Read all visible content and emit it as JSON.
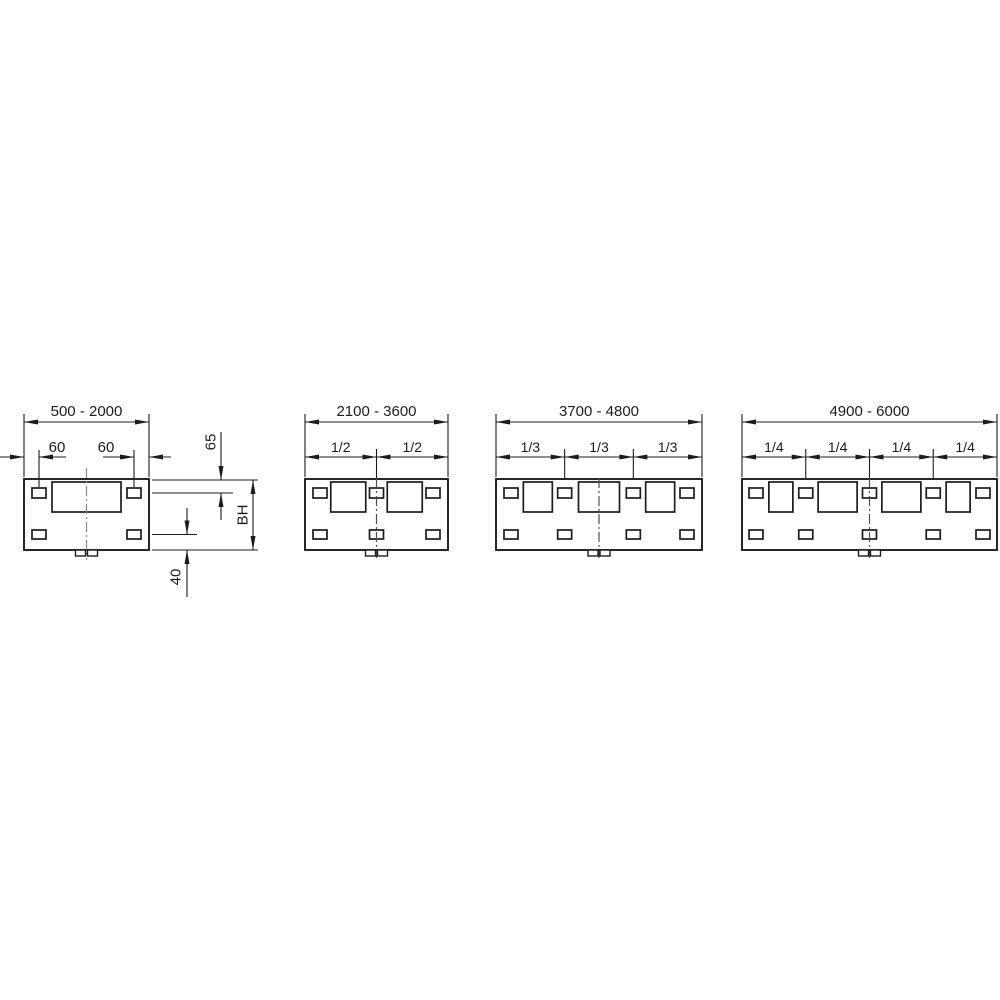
{
  "panels": [
    {
      "name": "panel-width-500-2000",
      "range_label": "500 - 2000",
      "dim_labels": {
        "hole_offset_left": "60",
        "hole_offset_right": "60",
        "top_to_hole": "65",
        "height": "BH",
        "hole_to_bottom": "40"
      },
      "fraction_labels": [],
      "cutouts": 1
    },
    {
      "name": "panel-width-2100-3600",
      "range_label": "2100 - 3600",
      "fraction_labels": [
        "1/2",
        "1/2"
      ],
      "cutouts": 2
    },
    {
      "name": "panel-width-3700-4800",
      "range_label": "3700 - 4800",
      "fraction_labels": [
        "1/3",
        "1/3",
        "1/3"
      ],
      "cutouts": 3
    },
    {
      "name": "panel-width-4900-6000",
      "range_label": "4900 - 6000",
      "fraction_labels": [
        "1/4",
        "1/4",
        "1/4",
        "1/4"
      ],
      "cutouts": 4
    }
  ],
  "colors": {
    "line": "#1c1c1c",
    "centerline_light": "#8a8a8a",
    "centerline_dark": "#4f4f4f",
    "background": "#ffffff"
  }
}
